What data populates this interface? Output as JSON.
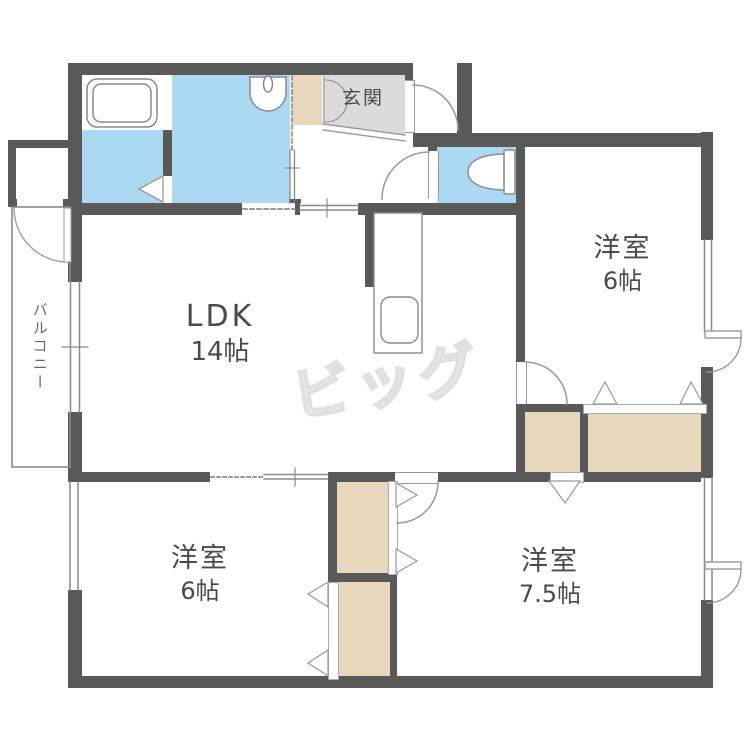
{
  "plan": {
    "rooms": {
      "ldk": {
        "name": "LDK",
        "size": "14帖"
      },
      "bedroom_top_right": {
        "name": "洋室",
        "size": "6帖"
      },
      "bedroom_bottom_left": {
        "name": "洋室",
        "size": "6帖"
      },
      "bedroom_bottom_right": {
        "name": "洋室",
        "size": "7.5帖"
      },
      "entrance": {
        "name": "玄関"
      },
      "balcony": {
        "name": "バルコニー"
      }
    },
    "watermark": "ビッグ",
    "fixtures": [
      "bathtub-icon",
      "washbasin-icon",
      "toilet-icon",
      "kitchen-sink-icon"
    ],
    "colors": {
      "wall": "#595959",
      "water_area": "#aad9f1",
      "closet": "#e9d7bd",
      "entrance_floor": "#dbdbdb",
      "outline": "#999999",
      "label": "#4a4a4a",
      "watermark_line": "#e0e0e0"
    }
  }
}
